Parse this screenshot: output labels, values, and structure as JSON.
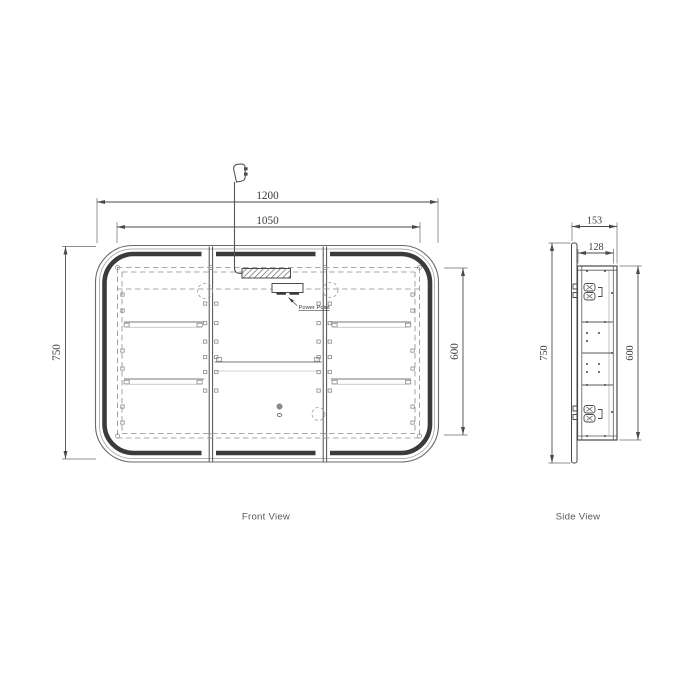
{
  "drawing": {
    "labels": {
      "front_view": "Front View",
      "side_view": "Side View"
    },
    "annotations": {
      "power_point": "Power Point"
    },
    "front_view": {
      "dimensions": {
        "overall_width_mm": "1200",
        "inner_width_mm": "1050",
        "overall_height_mm": "750",
        "inner_height_mm": "600"
      }
    },
    "side_view": {
      "dimensions": {
        "overall_depth_mm": "153",
        "inner_depth_mm": "128",
        "overall_height_mm": "750",
        "inner_height_mm": "600"
      }
    },
    "colors": {
      "background": "#ffffff",
      "line": "#4a4a4a",
      "frame_band": "#3b3b3b",
      "dashed": "#8d8d8d"
    }
  }
}
